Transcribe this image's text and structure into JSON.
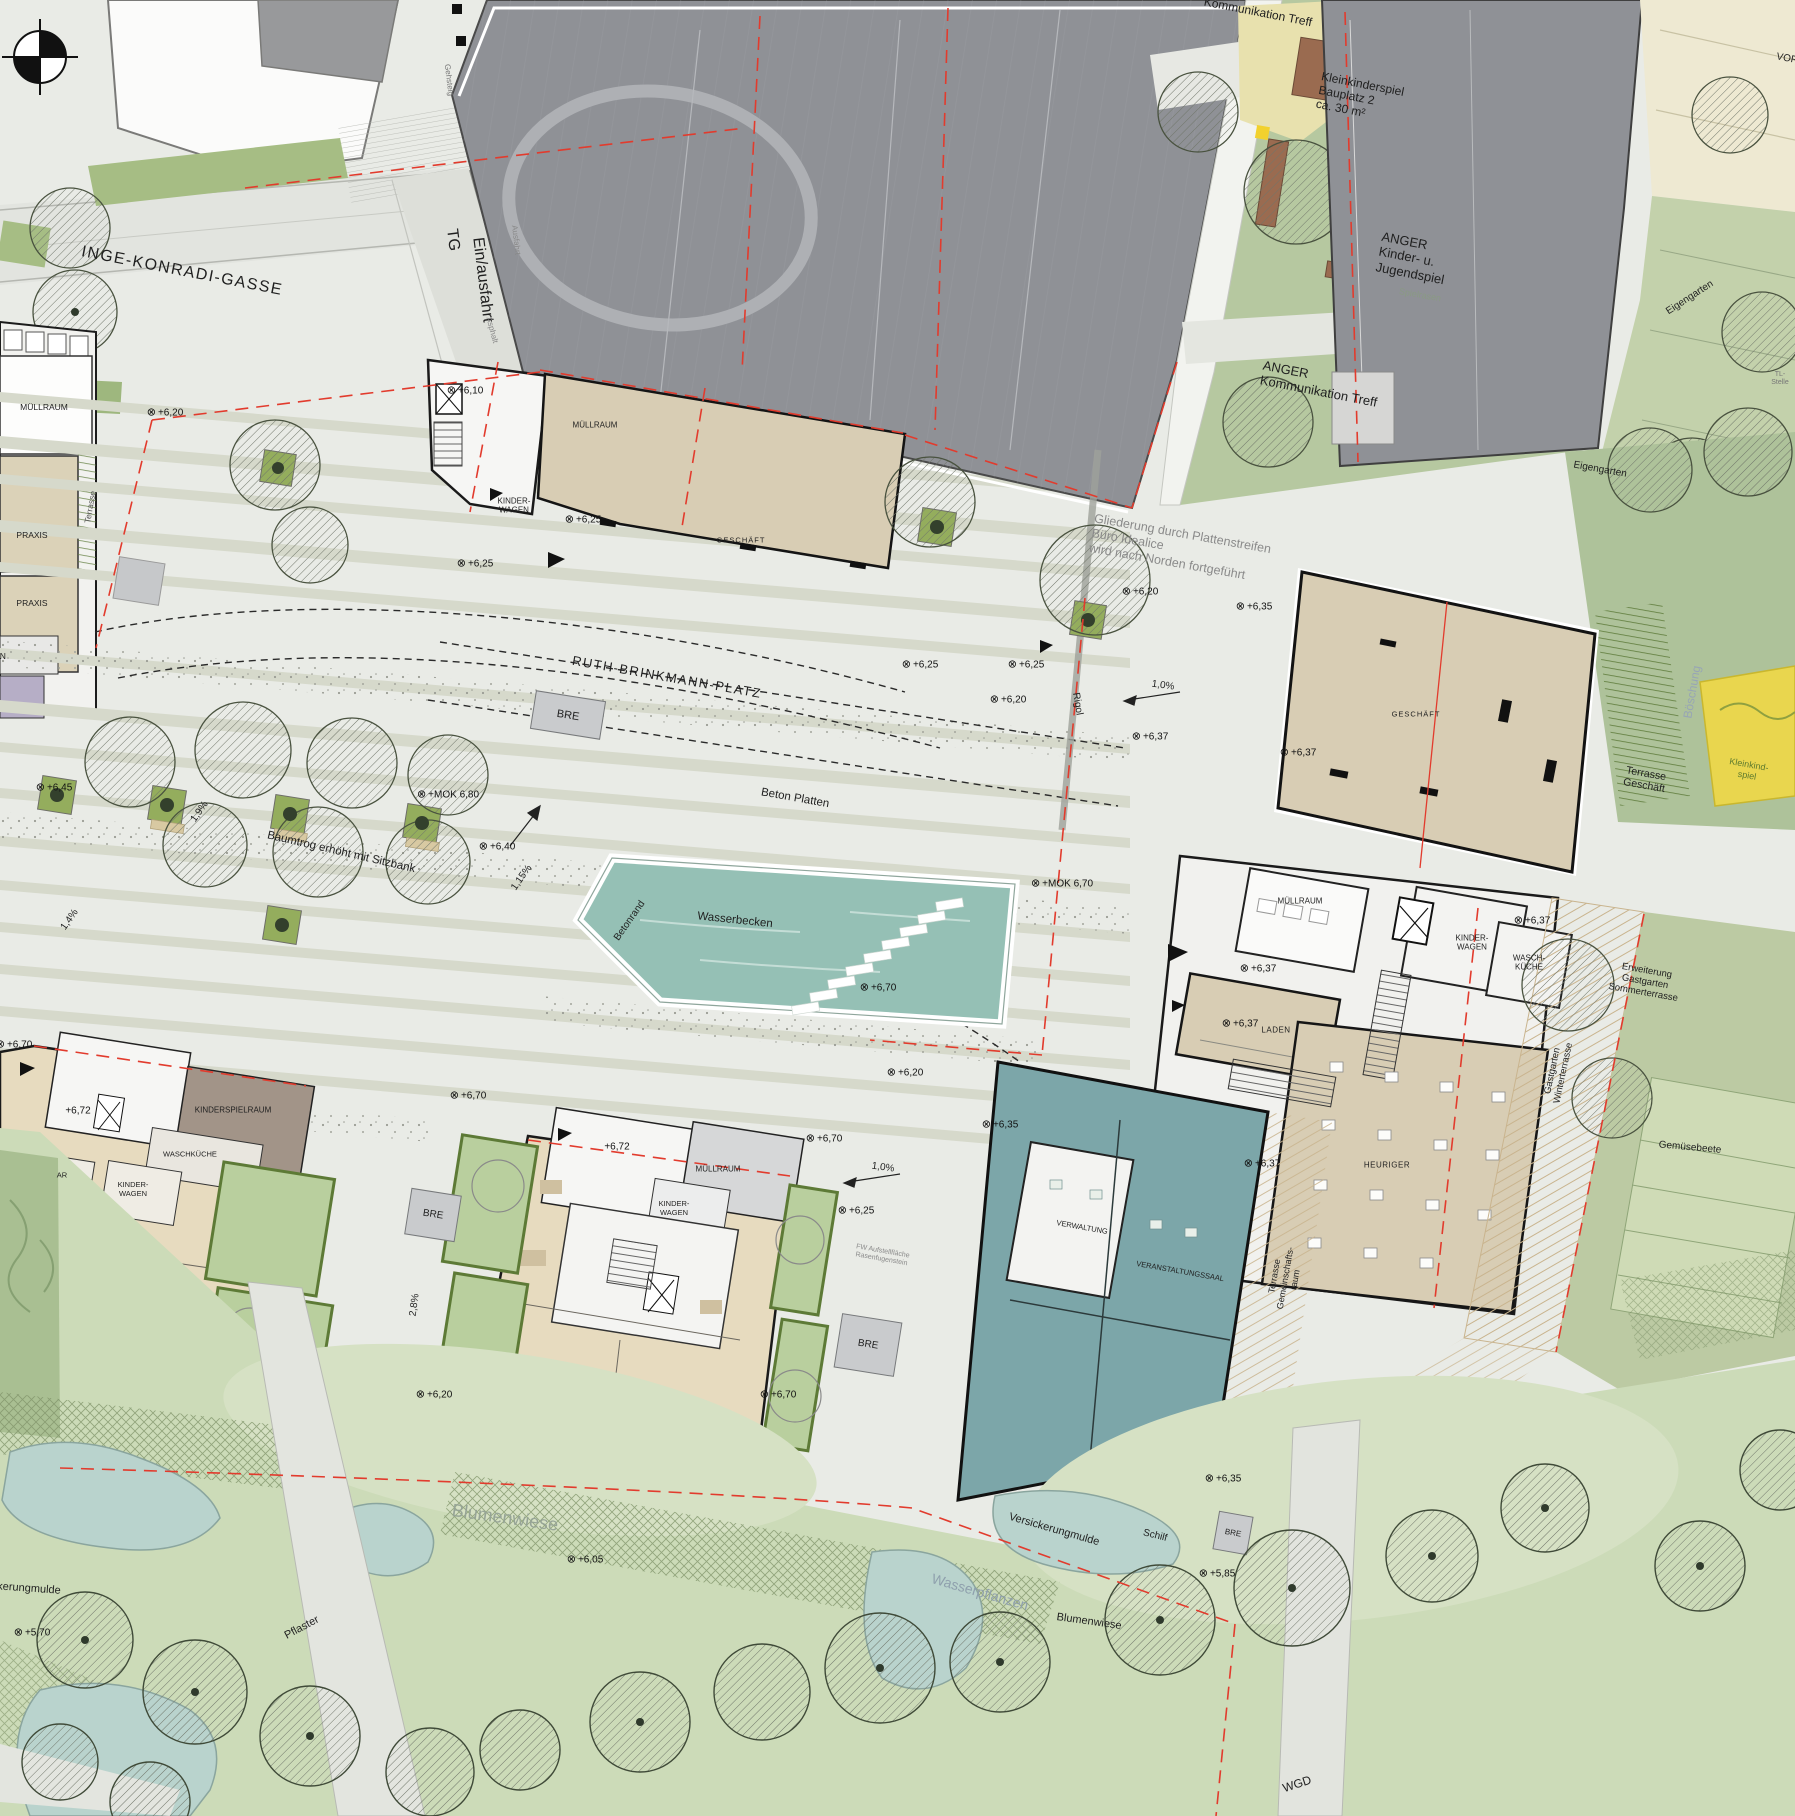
{
  "title": "Lageplan Ruth-Brinkmann-Platz",
  "icons": {
    "survey_marker": "⊗",
    "north_compass": "⊕"
  },
  "colors": {
    "plaza": "#e9ebe6",
    "building_beige": "#d8cdb4",
    "building_white": "#f2f2ef",
    "building_gray": "#8f9196",
    "building_teal": "#7ca6a9",
    "water_basin": "#95c0b5",
    "park_green": "#b6c8a0",
    "meadow": "#ccdbb8",
    "pond": "#b9d3cd",
    "garden_border": "#5d7a36",
    "boundary_red": "#e23b2d",
    "playground_yellow": "#e9d64e"
  },
  "labels": {
    "inge_konradi_gasse": "INGE-KONRADI-GASSE",
    "ein_ausfahrt": "Ein/ausfahrt",
    "tg": "TG",
    "gehsteig": "Gehsteig",
    "ausfahrt": "Ausfahrt",
    "asphalt": "Asphalt",
    "muellraum": "MÜLLRAUM",
    "praxis": "PRAXIS",
    "terrasse": "Terrasse",
    "wagen": "WAGEN",
    "kinder_wagen": "KINDER-\nWAGEN",
    "geschaeft": "GESCHÄFT",
    "ruth_brinkmann_platz": "RUTH-BRINKMANN-PLATZ",
    "bre": "BRE",
    "beton_platten": "Beton Platten",
    "baumtrog": "Baumtrog erhöht mit Sitzbank",
    "wasserbecken": "Wasserbecken",
    "betonrand": "Betonrand",
    "rigol": "Rigol",
    "gliederung": "Gliederung durch Plattenstreifen\nBüro Idealice\nwird nach Norden fortgeführt",
    "kleinkinderspiel_bauplatz": "Kleinkinderspiel\nBauplatz 2\nca. 30 m²",
    "anger_jugendspiel": "ANGER\nKinder- u.\nJugendspiel",
    "spielrasen": "Spielrasen",
    "anger_kommunikation": "ANGER\nKommunikation Treff",
    "kommunikation_treff": "Kommunikation Treff",
    "vorplatz": "VORPLATZ",
    "tl_stelle": "TL-Stelle",
    "eigengarten": "Eigengarten",
    "boeschung": "Böschung",
    "terrasse_geschaeft": "Terrasse\nGeschäft",
    "kleinkind_spiel": "Kleinkind-\nspiel",
    "laden": "LADEN",
    "heuriger": "HEURIGER",
    "wasch_kueche": "WASCH-\nKÜCHE",
    "verwaltung": "VERWALTUNG",
    "veranstaltungssaal": "VERANSTALTUNGSSAAL",
    "gastgarten_winterterrasse": "Gastgarten\nWinterterrasse",
    "erweiterung_gastgarten": "Erweiterung\nGastgarten\nSommerterrasse",
    "terrasse_gemeinschaftsraum": "Terrasse\nGemeinschafts-\nraum",
    "gemuesebeete": "Gemüsebeete",
    "kinderspielraum": "KINDERSPIELRAUM",
    "waschkueche": "WASCHKÜCHE",
    "ar": "AR",
    "fw_aufstellflaeche": "FW Aufstellfläche\nRasenfugenstein",
    "blumenwiese": "Blumenwiese",
    "versickerungmulde": "Versickerungmulde",
    "wasserpflanzen": "Wasserpflanzen",
    "schilf": "Schilf",
    "pflaster": "Pflaster",
    "wgd": "WGD",
    "p570": "+5,70",
    "p585": "+5,85",
    "p605": "+6,05",
    "p610": "+6,10",
    "p620": "+6,20",
    "p625": "+6,25",
    "p635": "+6,35",
    "p637": "+6,37",
    "p640": "+6,40",
    "p645": "+6,45",
    "p670": "+6,70",
    "p672": "+6,72",
    "mok670": "+MOK 6,70",
    "mok680": "+MOK 6,80",
    "s10": "1,0%",
    "s115": "1,15%",
    "s14": "1,4%",
    "s19": "1,9%",
    "s28": "2,8%"
  }
}
